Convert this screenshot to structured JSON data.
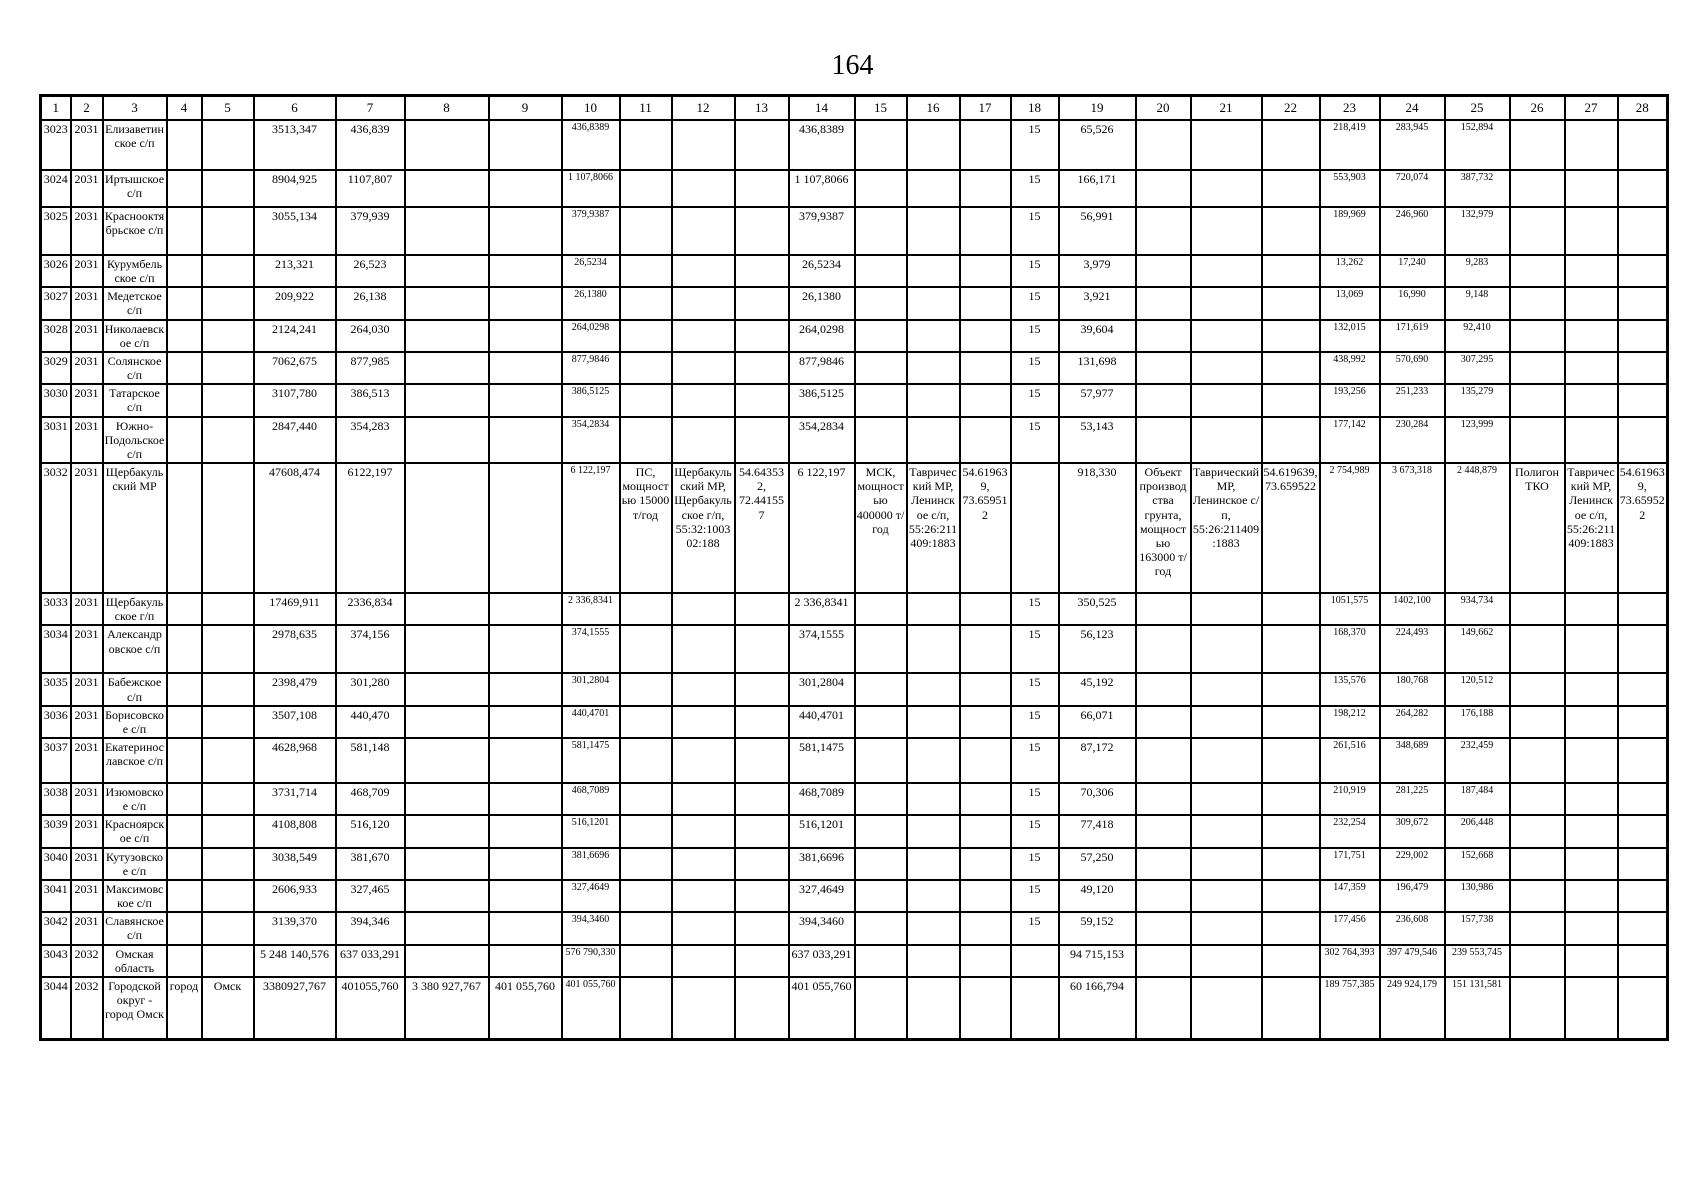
{
  "page_number": "164",
  "table": {
    "columns": [
      "1",
      "2",
      "3",
      "4",
      "5",
      "6",
      "7",
      "8",
      "9",
      "10",
      "11",
      "12",
      "13",
      "14",
      "15",
      "16",
      "17",
      "18",
      "19",
      "20",
      "21",
      "22",
      "23",
      "24",
      "25",
      "26",
      "27",
      "28"
    ],
    "rows": [
      {
        "c1": "3023",
        "c2": "2031",
        "c3": "Елизаветинское с/п",
        "c6": "3513,347",
        "c7": "436,839",
        "c10": "436,8389",
        "c14": "436,8389",
        "c18": "15",
        "c19": "65,526",
        "c23": "218,419",
        "c24": "283,945",
        "c25": "152,894"
      },
      {
        "c1": "3024",
        "c2": "2031",
        "c3": "Иртышское с/п",
        "c6": "8904,925",
        "c7": "1107,807",
        "c10": "1 107,8066",
        "c14": "1 107,8066",
        "c18": "15",
        "c19": "166,171",
        "c23": "553,903",
        "c24": "720,074",
        "c25": "387,732"
      },
      {
        "c1": "3025",
        "c2": "2031",
        "c3": "Краснооктябрьское с/п",
        "c6": "3055,134",
        "c7": "379,939",
        "c10": "379,9387",
        "c14": "379,9387",
        "c18": "15",
        "c19": "56,991",
        "c23": "189,969",
        "c24": "246,960",
        "c25": "132,979"
      },
      {
        "c1": "3026",
        "c2": "2031",
        "c3": "Курумбельское с/п",
        "c6": "213,321",
        "c7": "26,523",
        "c10": "26,5234",
        "c14": "26,5234",
        "c18": "15",
        "c19": "3,979",
        "c23": "13,262",
        "c24": "17,240",
        "c25": "9,283"
      },
      {
        "c1": "3027",
        "c2": "2031",
        "c3": "Медетское с/п",
        "c6": "209,922",
        "c7": "26,138",
        "c10": "26,1380",
        "c14": "26,1380",
        "c18": "15",
        "c19": "3,921",
        "c23": "13,069",
        "c24": "16,990",
        "c25": "9,148"
      },
      {
        "c1": "3028",
        "c2": "2031",
        "c3": "Николаевское с/п",
        "c6": "2124,241",
        "c7": "264,030",
        "c10": "264,0298",
        "c14": "264,0298",
        "c18": "15",
        "c19": "39,604",
        "c23": "132,015",
        "c24": "171,619",
        "c25": "92,410"
      },
      {
        "c1": "3029",
        "c2": "2031",
        "c3": "Солянское с/п",
        "c6": "7062,675",
        "c7": "877,985",
        "c10": "877,9846",
        "c14": "877,9846",
        "c18": "15",
        "c19": "131,698",
        "c23": "438,992",
        "c24": "570,690",
        "c25": "307,295"
      },
      {
        "c1": "3030",
        "c2": "2031",
        "c3": "Татарское с/п",
        "c6": "3107,780",
        "c7": "386,513",
        "c10": "386,5125",
        "c14": "386,5125",
        "c18": "15",
        "c19": "57,977",
        "c23": "193,256",
        "c24": "251,233",
        "c25": "135,279"
      },
      {
        "c1": "3031",
        "c2": "2031",
        "c3": "Южно-Подольское с/п",
        "c6": "2847,440",
        "c7": "354,283",
        "c10": "354,2834",
        "c14": "354,2834",
        "c18": "15",
        "c19": "53,143",
        "c23": "177,142",
        "c24": "230,284",
        "c25": "123,999"
      },
      {
        "c1": "3032",
        "c2": "2031",
        "c3": "Щербакульский МР",
        "c6": "47608,474",
        "c7": "6122,197",
        "c10": "6 122,197",
        "c11": "ПС, мощностью 15000 т/год",
        "c12": "Щербакульский МР, Щербакульское г/п, 55:32:100302:188",
        "c13": "54.643532, 72.441557",
        "c14": "6 122,197",
        "c15": "МСК, мощностью 400000 т/год",
        "c16": "Таврический МР, Ленинское с/п, 55:26:211409:1883",
        "c17": "54.619639, 73.659512",
        "c19": "918,330",
        "c20": "Объект производства грунта, мощностью 163000 т/год",
        "c21": "Таврический МР, Ленинское с/п, 55:26:211409:1883",
        "c22": "54.619639, 73.659522",
        "c23": "2 754,989",
        "c24": "3 673,318",
        "c25": "2 448,879",
        "c26": "Полигон ТКО",
        "c27": "Таврический МР, Ленинское с/п, 55:26:211409:1883",
        "c28": "54.619639, 73.659522"
      },
      {
        "c1": "3033",
        "c2": "2031",
        "c3": "Щербакульское г/п",
        "c6": "17469,911",
        "c7": "2336,834",
        "c10": "2 336,8341",
        "c14": "2 336,8341",
        "c18": "15",
        "c19": "350,525",
        "c23": "1051,575",
        "c24": "1402,100",
        "c25": "934,734"
      },
      {
        "c1": "3034",
        "c2": "2031",
        "c3": "Александровское с/п",
        "c6": "2978,635",
        "c7": "374,156",
        "c10": "374,1555",
        "c14": "374,1555",
        "c18": "15",
        "c19": "56,123",
        "c23": "168,370",
        "c24": "224,493",
        "c25": "149,662"
      },
      {
        "c1": "3035",
        "c2": "2031",
        "c3": "Бабежское с/п",
        "c6": "2398,479",
        "c7": "301,280",
        "c10": "301,2804",
        "c14": "301,2804",
        "c18": "15",
        "c19": "45,192",
        "c23": "135,576",
        "c24": "180,768",
        "c25": "120,512"
      },
      {
        "c1": "3036",
        "c2": "2031",
        "c3": "Борисовское с/п",
        "c6": "3507,108",
        "c7": "440,470",
        "c10": "440,4701",
        "c14": "440,4701",
        "c18": "15",
        "c19": "66,071",
        "c23": "198,212",
        "c24": "264,282",
        "c25": "176,188"
      },
      {
        "c1": "3037",
        "c2": "2031",
        "c3": "Екатеринославское с/п",
        "c6": "4628,968",
        "c7": "581,148",
        "c10": "581,1475",
        "c14": "581,1475",
        "c18": "15",
        "c19": "87,172",
        "c23": "261,516",
        "c24": "348,689",
        "c25": "232,459"
      },
      {
        "c1": "3038",
        "c2": "2031",
        "c3": "Изюмовское с/п",
        "c6": "3731,714",
        "c7": "468,709",
        "c10": "468,7089",
        "c14": "468,7089",
        "c18": "15",
        "c19": "70,306",
        "c23": "210,919",
        "c24": "281,225",
        "c25": "187,484"
      },
      {
        "c1": "3039",
        "c2": "2031",
        "c3": "Красноярское с/п",
        "c6": "4108,808",
        "c7": "516,120",
        "c10": "516,1201",
        "c14": "516,1201",
        "c18": "15",
        "c19": "77,418",
        "c23": "232,254",
        "c24": "309,672",
        "c25": "206,448"
      },
      {
        "c1": "3040",
        "c2": "2031",
        "c3": "Кутузовское с/п",
        "c6": "3038,549",
        "c7": "381,670",
        "c10": "381,6696",
        "c14": "381,6696",
        "c18": "15",
        "c19": "57,250",
        "c23": "171,751",
        "c24": "229,002",
        "c25": "152,668"
      },
      {
        "c1": "3041",
        "c2": "2031",
        "c3": "Максимовское с/п",
        "c6": "2606,933",
        "c7": "327,465",
        "c10": "327,4649",
        "c14": "327,4649",
        "c18": "15",
        "c19": "49,120",
        "c23": "147,359",
        "c24": "196,479",
        "c25": "130,986"
      },
      {
        "c1": "3042",
        "c2": "2031",
        "c3": "Славянское с/п",
        "c6": "3139,370",
        "c7": "394,346",
        "c10": "394,3460",
        "c14": "394,3460",
        "c18": "15",
        "c19": "59,152",
        "c23": "177,456",
        "c24": "236,608",
        "c25": "157,738"
      },
      {
        "c1": "3043",
        "c2": "2032",
        "c3": "Омская область",
        "c6": "5 248 140,576",
        "c7": "637 033,291",
        "c10": "576 790,330",
        "c14": "637 033,291",
        "c19": "94 715,153",
        "c23": "302 764,393",
        "c24": "397 479,546",
        "c25": "239 553,745"
      },
      {
        "c1": "3044",
        "c2": "2032",
        "c3": "Городской округ - город Омск",
        "c4": "город",
        "c5": "Омск",
        "c6": "3380927,767",
        "c7": "401055,760",
        "c8": "3 380 927,767",
        "c9": "401 055,760",
        "c10": "401 055,760",
        "c14": "401 055,760",
        "c19": "60 166,794",
        "c23": "189 757,385",
        "c24": "249 924,179",
        "c25": "151 131,581"
      }
    ]
  }
}
